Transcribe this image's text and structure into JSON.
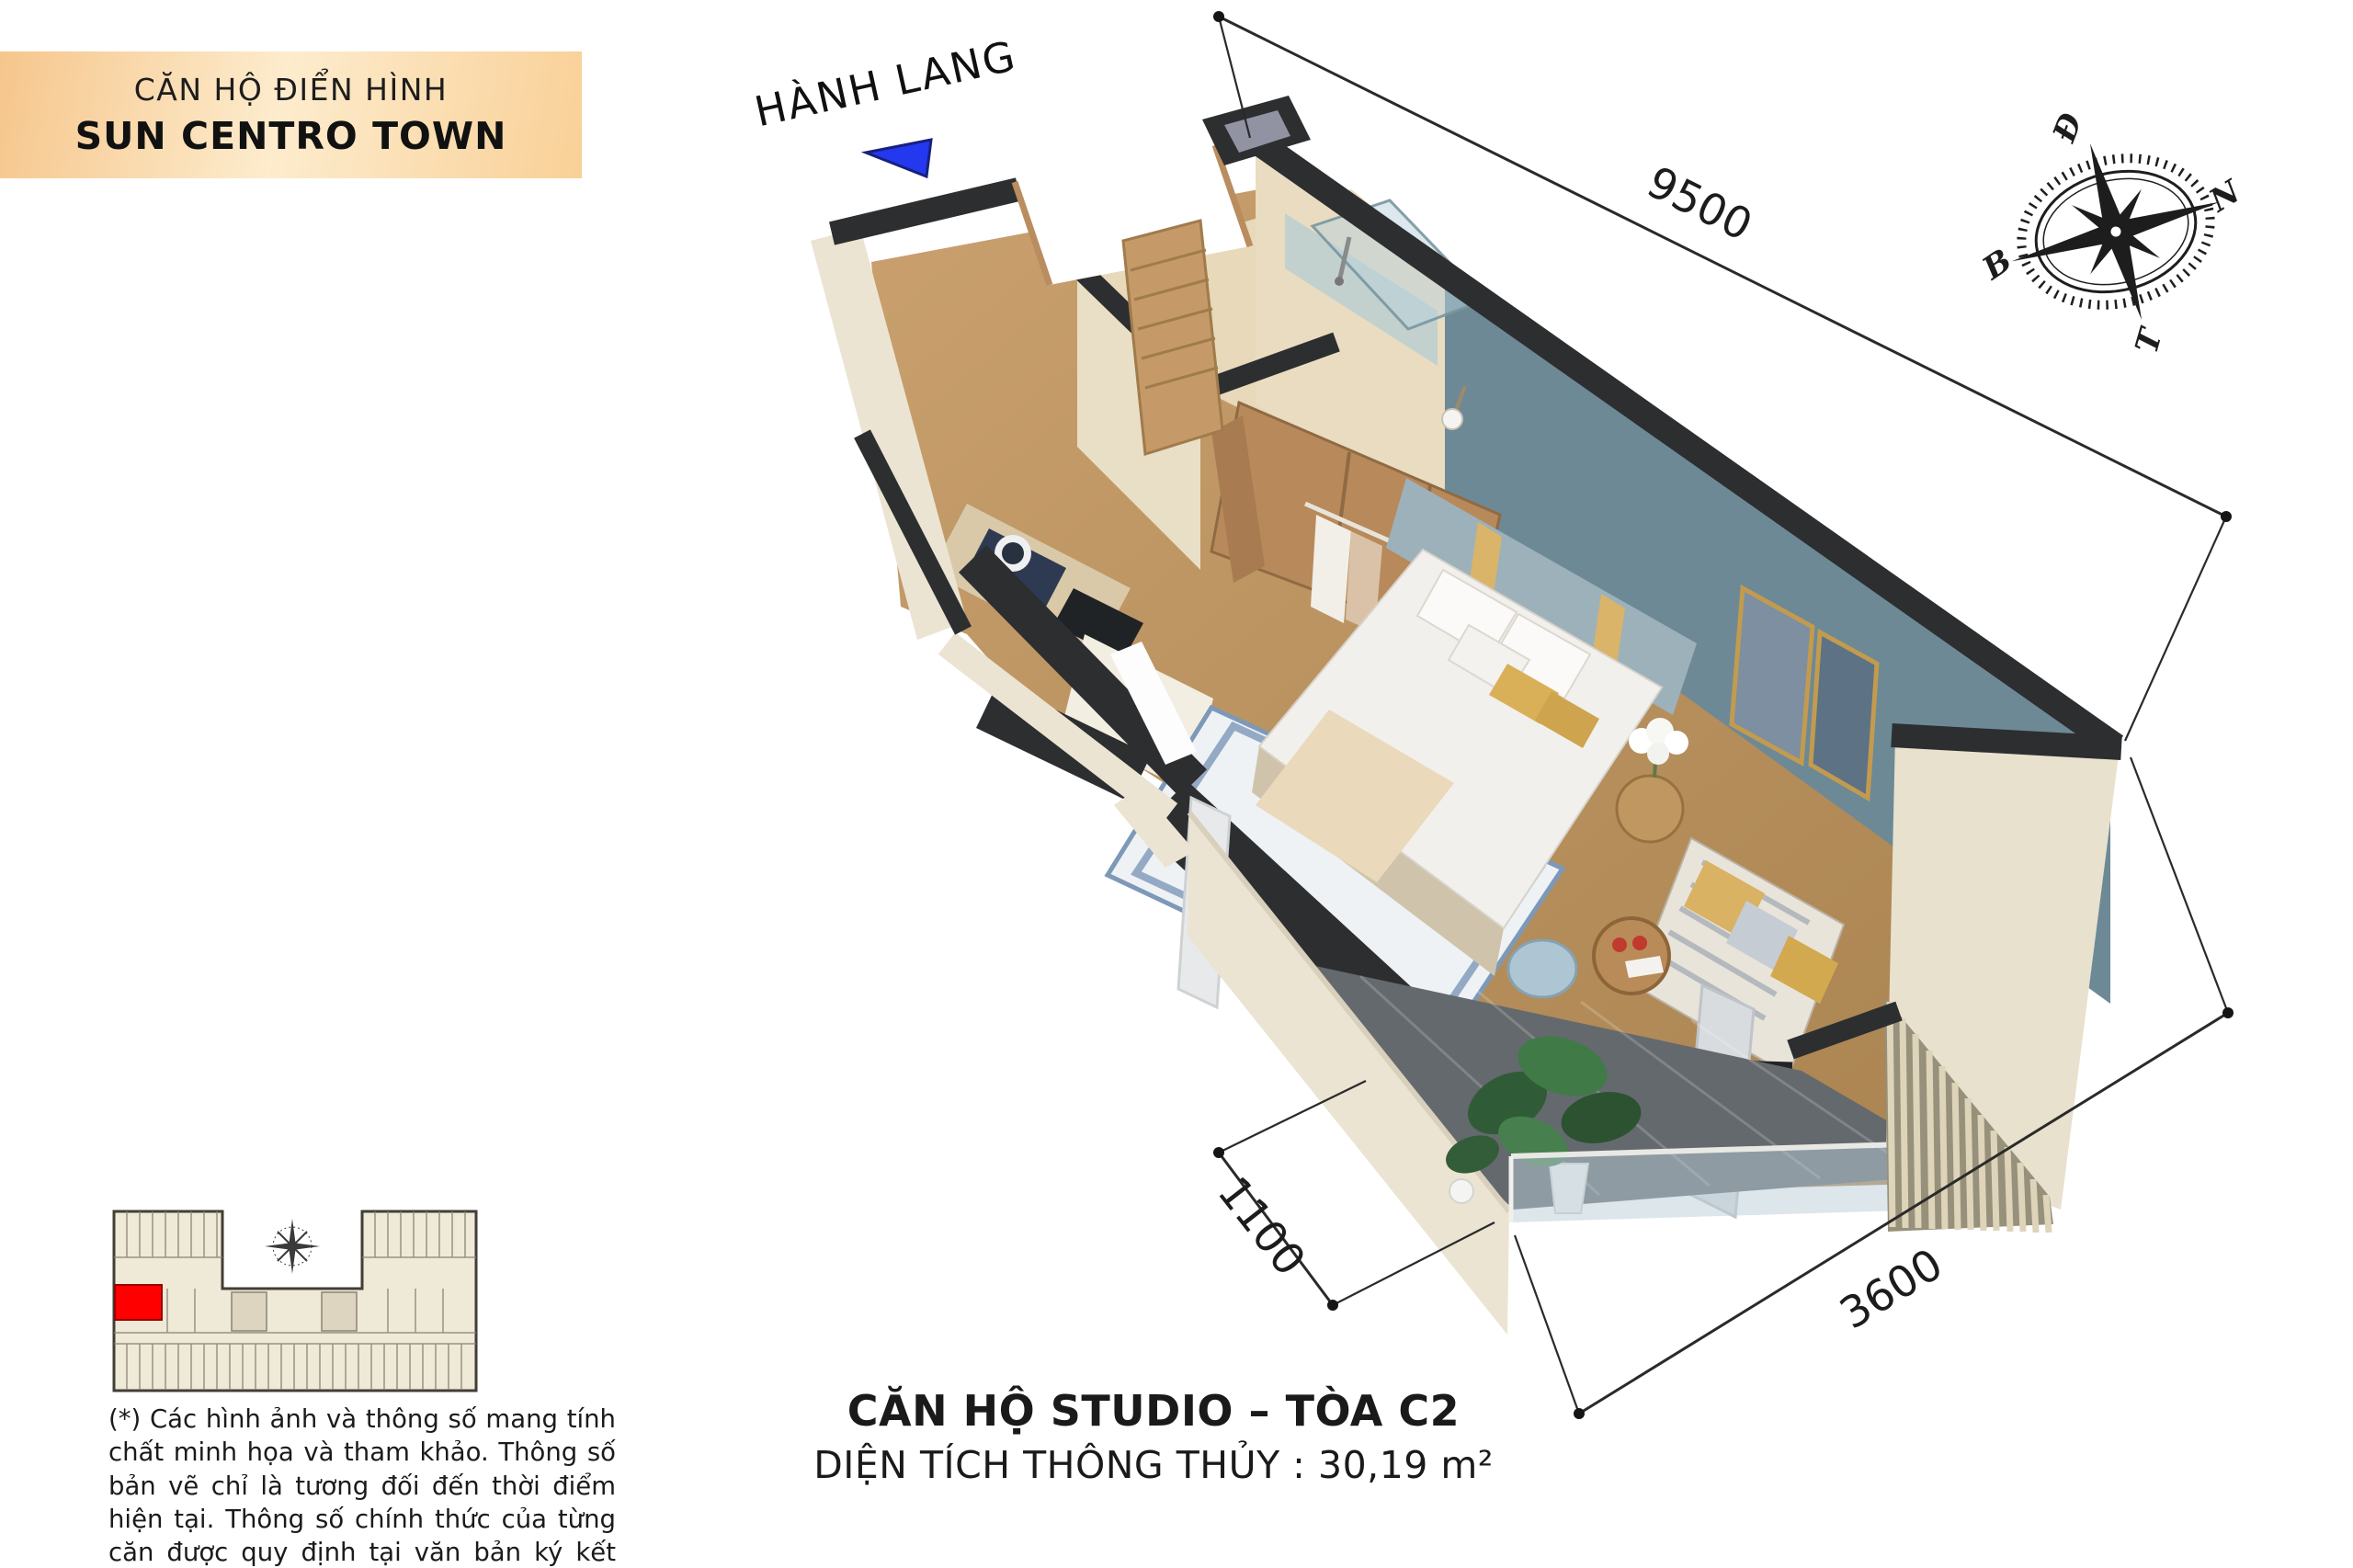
{
  "badge": {
    "line1": "CĂN HỘ ĐIỂN HÌNH",
    "line2": "SUN CENTRO TOWN"
  },
  "corridor_label": "HÀNH LANG",
  "dimensions": {
    "length": "9500",
    "balcony_depth": "1100",
    "width": "3600"
  },
  "compass": {
    "east": "Đ",
    "south": "N",
    "west": "T",
    "north": "B"
  },
  "title": {
    "line1": "CĂN HỘ STUDIO – TÒA C2",
    "line2": "DIỆN TÍCH THÔNG THỦY : 30,19 m²"
  },
  "disclaimer": "(*) Các hình ảnh và thông số mang tính chất minh họa và tham khảo. Thông số bản vẽ chỉ là tương đối đến thời điểm hiện tại. Thông số chính thức của từng căn được quy định tại văn bản ký kết với Khách hàng/Theo quy định của CQNN.",
  "colors": {
    "badge_gradient_start": "#f6c68c",
    "badge_gradient_mid": "#fdeccd",
    "badge_gradient_end": "#f9d097",
    "arrow_blue": "#2438ef",
    "accent_wall_blue": "#6d8996",
    "wall_dark": "#2d2e30",
    "wall_cream": "#ebe4d2",
    "wood": "#b8895a",
    "keyplan_highlight": "#fe0000"
  }
}
